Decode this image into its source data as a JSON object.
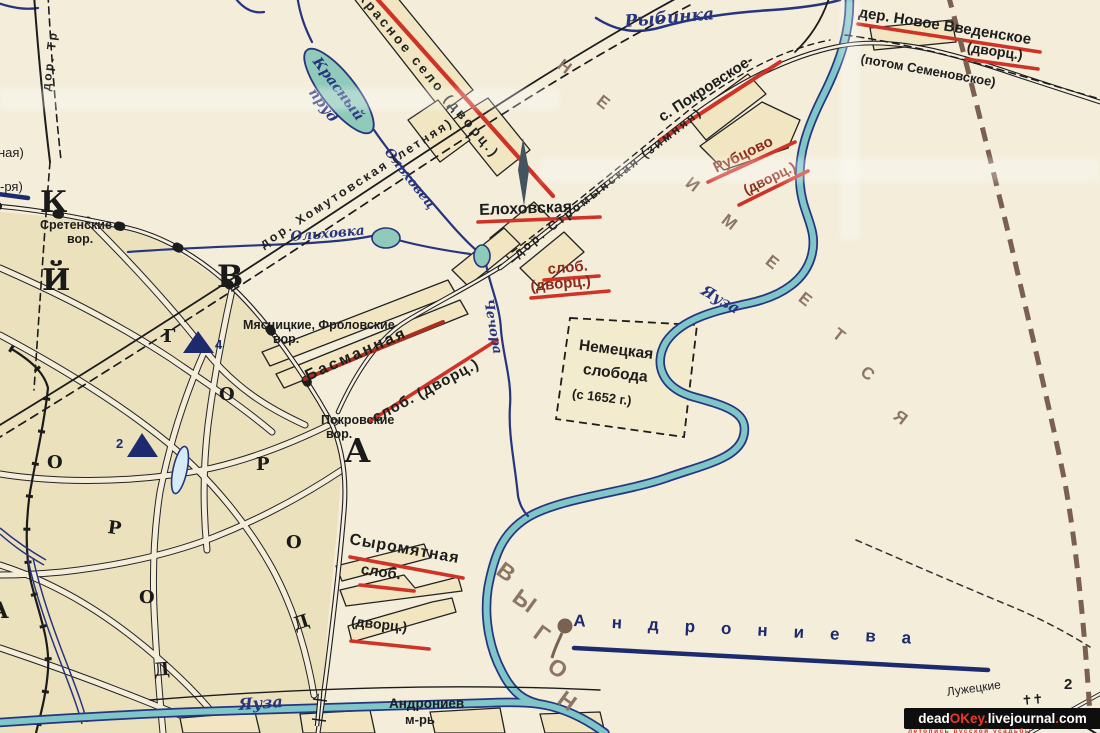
{
  "water_labels": {
    "rybinka": "Рыбинка",
    "krasny_prud_line1": "Красный",
    "krasny_prud_line2": "пруд",
    "olkhovets": "Ольховец",
    "olkhovka": "Ольховка",
    "yauza_upper": "Яуза",
    "chechora": "Чечора",
    "yauza_lower": "Яуза"
  },
  "roads": {
    "stromynskaya": "дор. Стромынская (зимняя)",
    "khomutovskaya": "дор. Хомутовская (летняя)",
    "troitskaya_partial": "дор. Тр",
    "krasnoe_selo": "Красное село (дворц.)"
  },
  "settlements": {
    "novoe_vvedenskoe": "дер. Новое Введенское",
    "novoe_vvedenskoe_dvorts": "(дворц.)",
    "potom_semenovskoe": "(потом Семеновское)",
    "pokrovskoe": "с. Покровское-",
    "rubtsovo": "Рубцово",
    "rubtsovo_dvorts": "(дворц.)",
    "elokhovskaya": "Елоховская",
    "elokhovskaya_slob": "слоб.",
    "elokhovskaya_dvorts": "(дворц.)",
    "basmannaya": "Басманная",
    "basmannaya_slob": "слоб. (дворц.)",
    "syromyatnaya": "Сыромятная",
    "syromyatnaya_slob": "слоб.",
    "syromyatnaya_dvorts": "(дворц.)",
    "nemetskaya_line1": "Немецкая",
    "nemetskaya_line2": "слобода",
    "nemetskaya_line3": "(с 1652 г.)",
    "andronieva": "Андрониева",
    "andronievsky_line1": "Андрониев",
    "andronievsky_line2": "м-рь",
    "luzhetskie": "Лужецкие"
  },
  "gates": {
    "sretenskie_line1": "Сретенские",
    "sretenskie_line2": "вор.",
    "myasnitskie_line1": "Мясницкие, Фроловские",
    "myasnitskie_line2": "вор.",
    "pokrovskie_line1": "Покровские",
    "pokrovskie_line2": "вор."
  },
  "edge_labels": {
    "partial_naya": "ная)",
    "partial_rya": "-ря)"
  },
  "big_letters": {
    "k": "К",
    "y": "Й",
    "v": "В",
    "g": "Г",
    "a": "А",
    "o1": "О",
    "r1": "Р",
    "o2": "О",
    "d1": "Д",
    "o3": "О",
    "r2": "Р",
    "o4": "О",
    "d2": "Д",
    "a2": "А"
  },
  "brown_letters": {
    "neimeetsya": [
      "Н",
      "Е",
      "И",
      "М",
      "Е",
      "Е",
      "Т",
      "С",
      "Я"
    ],
    "vygon": [
      "В",
      "Ы",
      "Г",
      "О",
      "Н"
    ]
  },
  "markers": {
    "triangle4_label": "4",
    "triangle2_label": "2",
    "boundary_number": "2",
    "crosses": "✝✝"
  },
  "watermark": {
    "dead": "dead",
    "okey": "OKey",
    "dot1": ".",
    "livejournal": "livejournal",
    "dot2": ".",
    "com": "com",
    "tagline": "летопись русской усадьбы"
  },
  "colors": {
    "paper": "#f3edda",
    "city_fill": "#ece1bd",
    "settlement_fill": "#f1e6c1",
    "river_teal": "#7fc6c9",
    "water_navy": "#27357f",
    "underline_red": "#cf3226",
    "dark_red_text": "#8c2a1b",
    "brown_letters": "#8d7565",
    "boundary_brown": "#7b5f50"
  }
}
